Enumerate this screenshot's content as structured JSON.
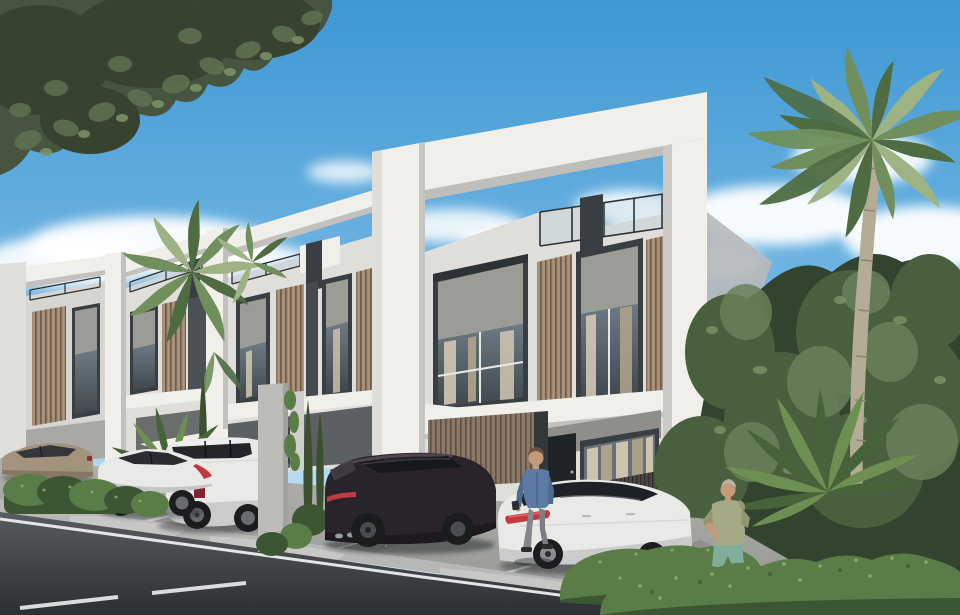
{
  "scene": {
    "description": "Photorealistic architectural rendering of a row of modern two-storey townhouses with white concrete portal frames, bronze louvre cladding, rooftop glass railings, parked cars, a walking man, a jogging elderly man, palm trees, hedges and an asphalt street in daylight",
    "time_of_day": "day",
    "sky": {
      "condition": "blue with scattered white clouds"
    },
    "buildings": [
      {
        "name": "main-townhouse",
        "features": [
          "white concrete portal frame",
          "roof terrace with glass railing",
          "two upper windows with gray stucco headers and curtains",
          "bronze vertical louvre panels",
          "black front door",
          "ground-floor window with beige curtains",
          "carport with louvre back wall"
        ]
      },
      {
        "name": "townhouse-2",
        "features": [
          "portal frame",
          "roof railing",
          "louvre panels",
          "windows",
          "white carport canopy"
        ]
      },
      {
        "name": "townhouse-3",
        "features": [
          "portal frame",
          "roof railing",
          "louvre panel",
          "window"
        ]
      },
      {
        "name": "townhouse-4",
        "features": [
          "portal frame edge",
          "louvre panel",
          "window"
        ]
      }
    ],
    "vehicles": [
      {
        "name": "beige-sedan",
        "color": "champagne beige",
        "position": "far left behind hedge"
      },
      {
        "name": "white-coupe",
        "color": "white",
        "position": "left, fastback seen from rear"
      },
      {
        "name": "white-suv",
        "color": "white",
        "position": "left of concrete pillar, red door badge"
      },
      {
        "name": "dark-suv",
        "color": "very dark aubergine",
        "position": "center, rear three-quarter view"
      },
      {
        "name": "white-sedan-tesla",
        "color": "white with black glass roof",
        "position": "center-right, red tail-light band"
      }
    ],
    "people": [
      {
        "name": "pedestrian-man",
        "clothing": "blue denim shirt, gray trousers, dark shoes",
        "action": "walking between the dark SUV and the white sedan"
      },
      {
        "name": "jogger-man",
        "clothing": "sage hoodie, teal shorts",
        "hair": "gray",
        "action": "jogging behind the front hedge on the right"
      }
    ],
    "vegetation": [
      "dark leafy tree canopy top-left",
      "fan palms behind left townhouses",
      "tall fan palm on the right",
      "dense dark foliage right side",
      "sago palm right",
      "sago palm left",
      "columnar cypresses",
      "scalloped hedge row left",
      "bright hedges bottom right"
    ],
    "road": {
      "surface": "dark asphalt",
      "markings": [
        "solid white edge line",
        "white dashed center line",
        "white parking bay lines"
      ],
      "details": [
        "light concrete curb with ramp pads",
        "gravel strips between parking bays"
      ]
    }
  },
  "palette": {
    "sky-top": "#3e97d3",
    "sky-mid": "#6fb4e2",
    "sky-low": "#b9ddf1",
    "sky-horizon": "#d8edf8",
    "cloud": "#ffffff",
    "concrete-lit": "#f1efe9",
    "concrete-front": "#e0deda",
    "concrete-shade": "#c2c1bd",
    "concrete-deep": "#a9a8a5",
    "stucco": "#9c9c97",
    "stucco-dark": "#8e8e8a",
    "frame-dark": "#383e42",
    "door-dark": "#1f2427",
    "railing": "#2c3134",
    "glass-top": "#6e7a84",
    "glass-bottom": "#3f474d",
    "glass-light": "#aec9d8",
    "curtain": "#d2c7b2",
    "curtain-dark": "#b1a58c",
    "slat-light": "#a28a74",
    "slat-line": "#6e5c4b",
    "slat-dark": "#8c7866",
    "slat-dark-line": "#5c5042",
    "slat-base": "#4a4742",
    "pavement": "#b0b1ae",
    "pavement-dark": "#94968f",
    "gravel": "#90928e",
    "curb": "#b7b8b5",
    "ramp": "#c7c8c5",
    "road-top": "#595c5e",
    "road-bottom": "#2c2f32",
    "road-line": "#e3e6e5",
    "hedge-dark": "#3c5634",
    "hedge-mid": "#5a7c47",
    "hedge-light": "#7da35c",
    "hedge-speck": "#8db46d",
    "foliage-dark": "#32432e",
    "foliage-mid": "#49603e",
    "foliage-light": "#69815a",
    "foliage-speck": "#7d9468",
    "canopy": "#465440",
    "canopy-dark": "#37432f",
    "canopy-light": "#5d7050",
    "palm-light": "#9db384",
    "palm-mid": "#708f5c",
    "palm-dark": "#4e6b42",
    "trunk": "#b4ac97",
    "trunk-dark": "#8e8672",
    "cypress": "#3a5030",
    "sago": "#6d8f52",
    "sago-dark": "#47633a",
    "car-white": "#e9eae8",
    "car-white-shade": "#c9ccca",
    "car-beige": "#a2937c",
    "car-dark": "#29242b",
    "car-dark-hi": "#4e4550",
    "tire": "#1a1c1e",
    "rim": "#6a6d70",
    "tail-red": "#c03a42",
    "badge-red": "#7e2430",
    "skin": "#c49a7b",
    "hair-brown": "#6b5140",
    "hair-gray": "#b8b4ad",
    "denim": "#5d7aa2",
    "denim-dark": "#4f6a8f",
    "pants-gray": "#84878a",
    "hoodie": "#a6a985",
    "hoodie-shade": "#93966f",
    "shorts-teal": "#7fae9b",
    "shoe-dark": "#2b2d2f",
    "shadow": "#1f2225"
  }
}
